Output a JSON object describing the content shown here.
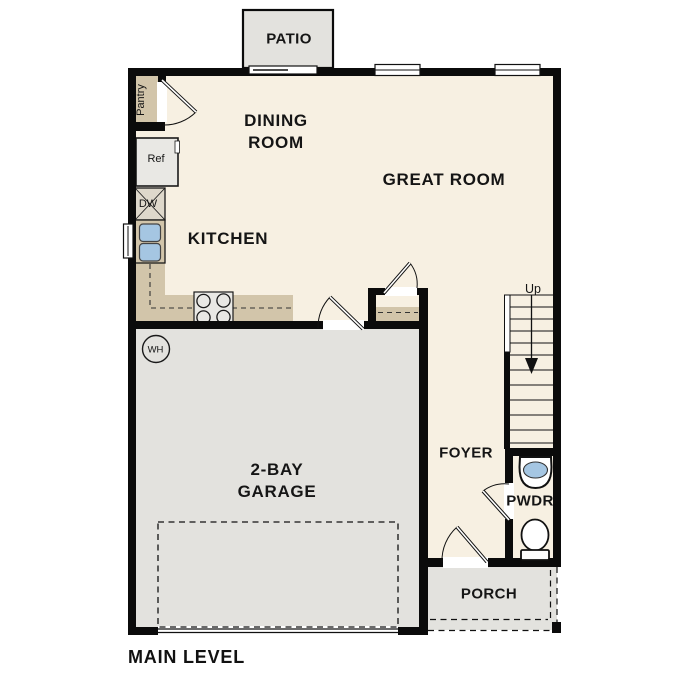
{
  "title": "MAIN LEVEL",
  "rooms": {
    "patio": "PATIO",
    "dining_room": "DINING ROOM",
    "great_room": "GREAT ROOM",
    "kitchen": "KITCHEN",
    "pantry": "Pantry",
    "garage": "2-BAY GARAGE",
    "foyer": "FOYER",
    "powder": "PWDR",
    "porch": "PORCH"
  },
  "fixtures": {
    "refrigerator": "Ref",
    "dishwasher": "DW",
    "water_heater": "WH",
    "stairs_direction": "Up"
  },
  "colors": {
    "floor": "#f7f0e2",
    "gray": "#e3e2de",
    "counter": "#d2c5aa",
    "appliance": "#e9e8e4",
    "dw_fill": "#ded8cb",
    "sink": "#a5c6e2",
    "wall": "#0b0b0b"
  }
}
